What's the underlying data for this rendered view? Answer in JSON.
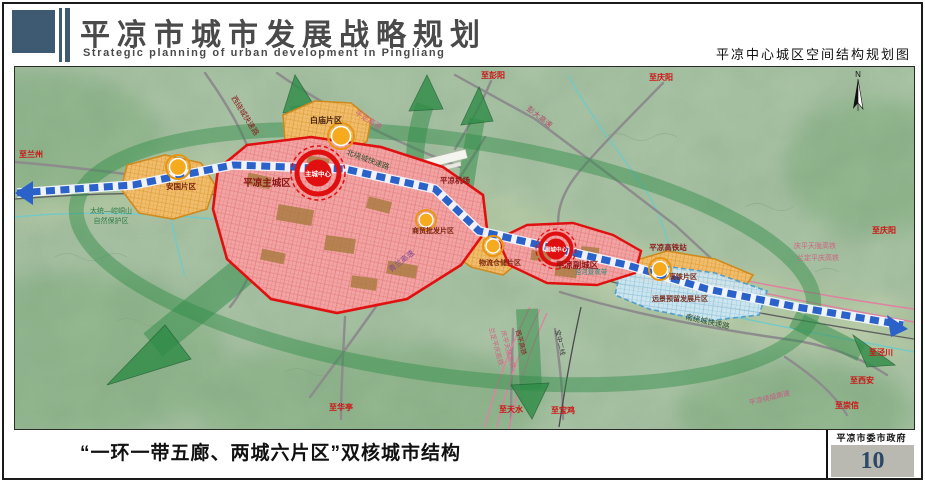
{
  "header": {
    "title": "平凉市城市发展战略规划",
    "subtitle": "Strategic planning of urban development in Pingliang",
    "map_title": "平凉中心城区空间结构规划图"
  },
  "footer": {
    "caption": "“一环一带五廊、两城六片区”双核城市结构",
    "agency": "平凉市委市政府",
    "page_number": "10"
  },
  "map": {
    "compass": "N",
    "centers": {
      "main": "主城中心",
      "sub": "副城中心"
    },
    "districts": {
      "main_city": "平凉主城区",
      "sub_city": "平凉副城区",
      "anguo": "安国片区",
      "baimiao": "白庙片区",
      "trade": "商贸批发片区",
      "logistics": "物流仓储片区",
      "hsr": "高铁片区",
      "reserved": "远景预留发展片区"
    },
    "roads": {
      "west_ring": "西绕城快速路",
      "north_ring": "北绕城快速路",
      "south_ring": "南绕城快速路",
      "pingding": "平定高速",
      "pengda": "彭大高速",
      "qinglan": "青兰高速",
      "ring_expwy": "平凉绕城高速"
    },
    "rails": {
      "xiping": "西平高铁",
      "qingping_tianlong": "庆平天陇高铁",
      "landing_pingqing": "兰定平庆高铁",
      "baozhong": "宝中二线"
    },
    "destinations": {
      "lanzhou": "至兰州",
      "pengyang": "至彭阳",
      "qingyang": "至庆阳",
      "huating": "至华亭",
      "tianshui": "至天水",
      "baoji": "至宝鸡",
      "xian": "至西安",
      "chongxin": "至崇信",
      "jingchuan": "至泾川"
    },
    "nature": {
      "reserve_line1": "太统—崆峒山",
      "reserve_line2": "自然保护区",
      "jinghe_belt": "泾河景观带"
    },
    "airport": "平凉机场",
    "hsr_station": "平凉高铁站"
  },
  "colors": {
    "corridor_green": "#2f8c47",
    "axis_blue": "#2a62c9",
    "core_red": "#e01010",
    "district_orange": "#f1bd6d",
    "city_pink": "#f2a3a3",
    "reserved_blue": "#cfe8f5",
    "terrain": "#aec6a9",
    "logo_slate": "#3d5a72"
  }
}
